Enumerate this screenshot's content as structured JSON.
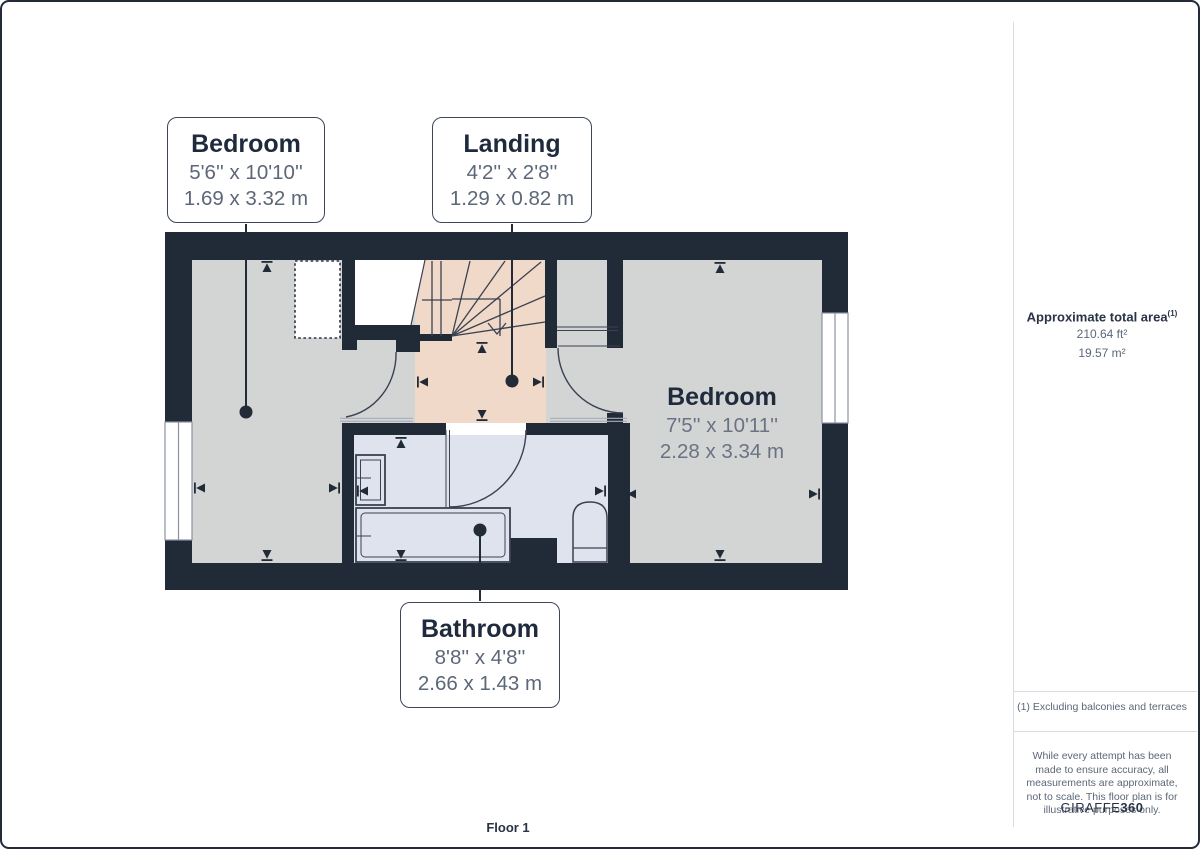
{
  "callouts": {
    "bedroom_small": {
      "title": "Bedroom",
      "imperial": "5'6'' x 10'10''",
      "metric": "1.69 x 3.32 m"
    },
    "landing": {
      "title": "Landing",
      "imperial": "4'2'' x 2'8''",
      "metric": "1.29 x 0.82 m"
    },
    "bathroom": {
      "title": "Bathroom",
      "imperial": "8'8'' x 4'8''",
      "metric": "2.66 x 1.43 m"
    }
  },
  "room_labels": {
    "bedroom_large": {
      "title": "Bedroom",
      "imperial": "7'5'' x 10'11''",
      "metric": "2.28 x 3.34 m"
    }
  },
  "sidebar": {
    "area_title": "Approximate total area",
    "area_footnote_marker": "(1)",
    "area_imperial": "210.64 ft²",
    "area_metric": "19.57 m²",
    "footnote": "(1) Excluding balconies and terraces",
    "disclaimer": "While every attempt has been made to ensure accuracy, all measurements are approximate, not to scale. This floor plan is for illustrative purposes only.",
    "logo_text": "GIRAFFE",
    "logo_number": "360"
  },
  "footer": {
    "floor_label": "Floor 1"
  },
  "colors": {
    "wall": "#212a37",
    "room_gray": "#d3d4d4",
    "landing_peach": "#f0d9c8",
    "bathroom_blue": "#dfe3ee",
    "text_dark": "#1f2b3d",
    "text_gray": "#5c6778"
  }
}
